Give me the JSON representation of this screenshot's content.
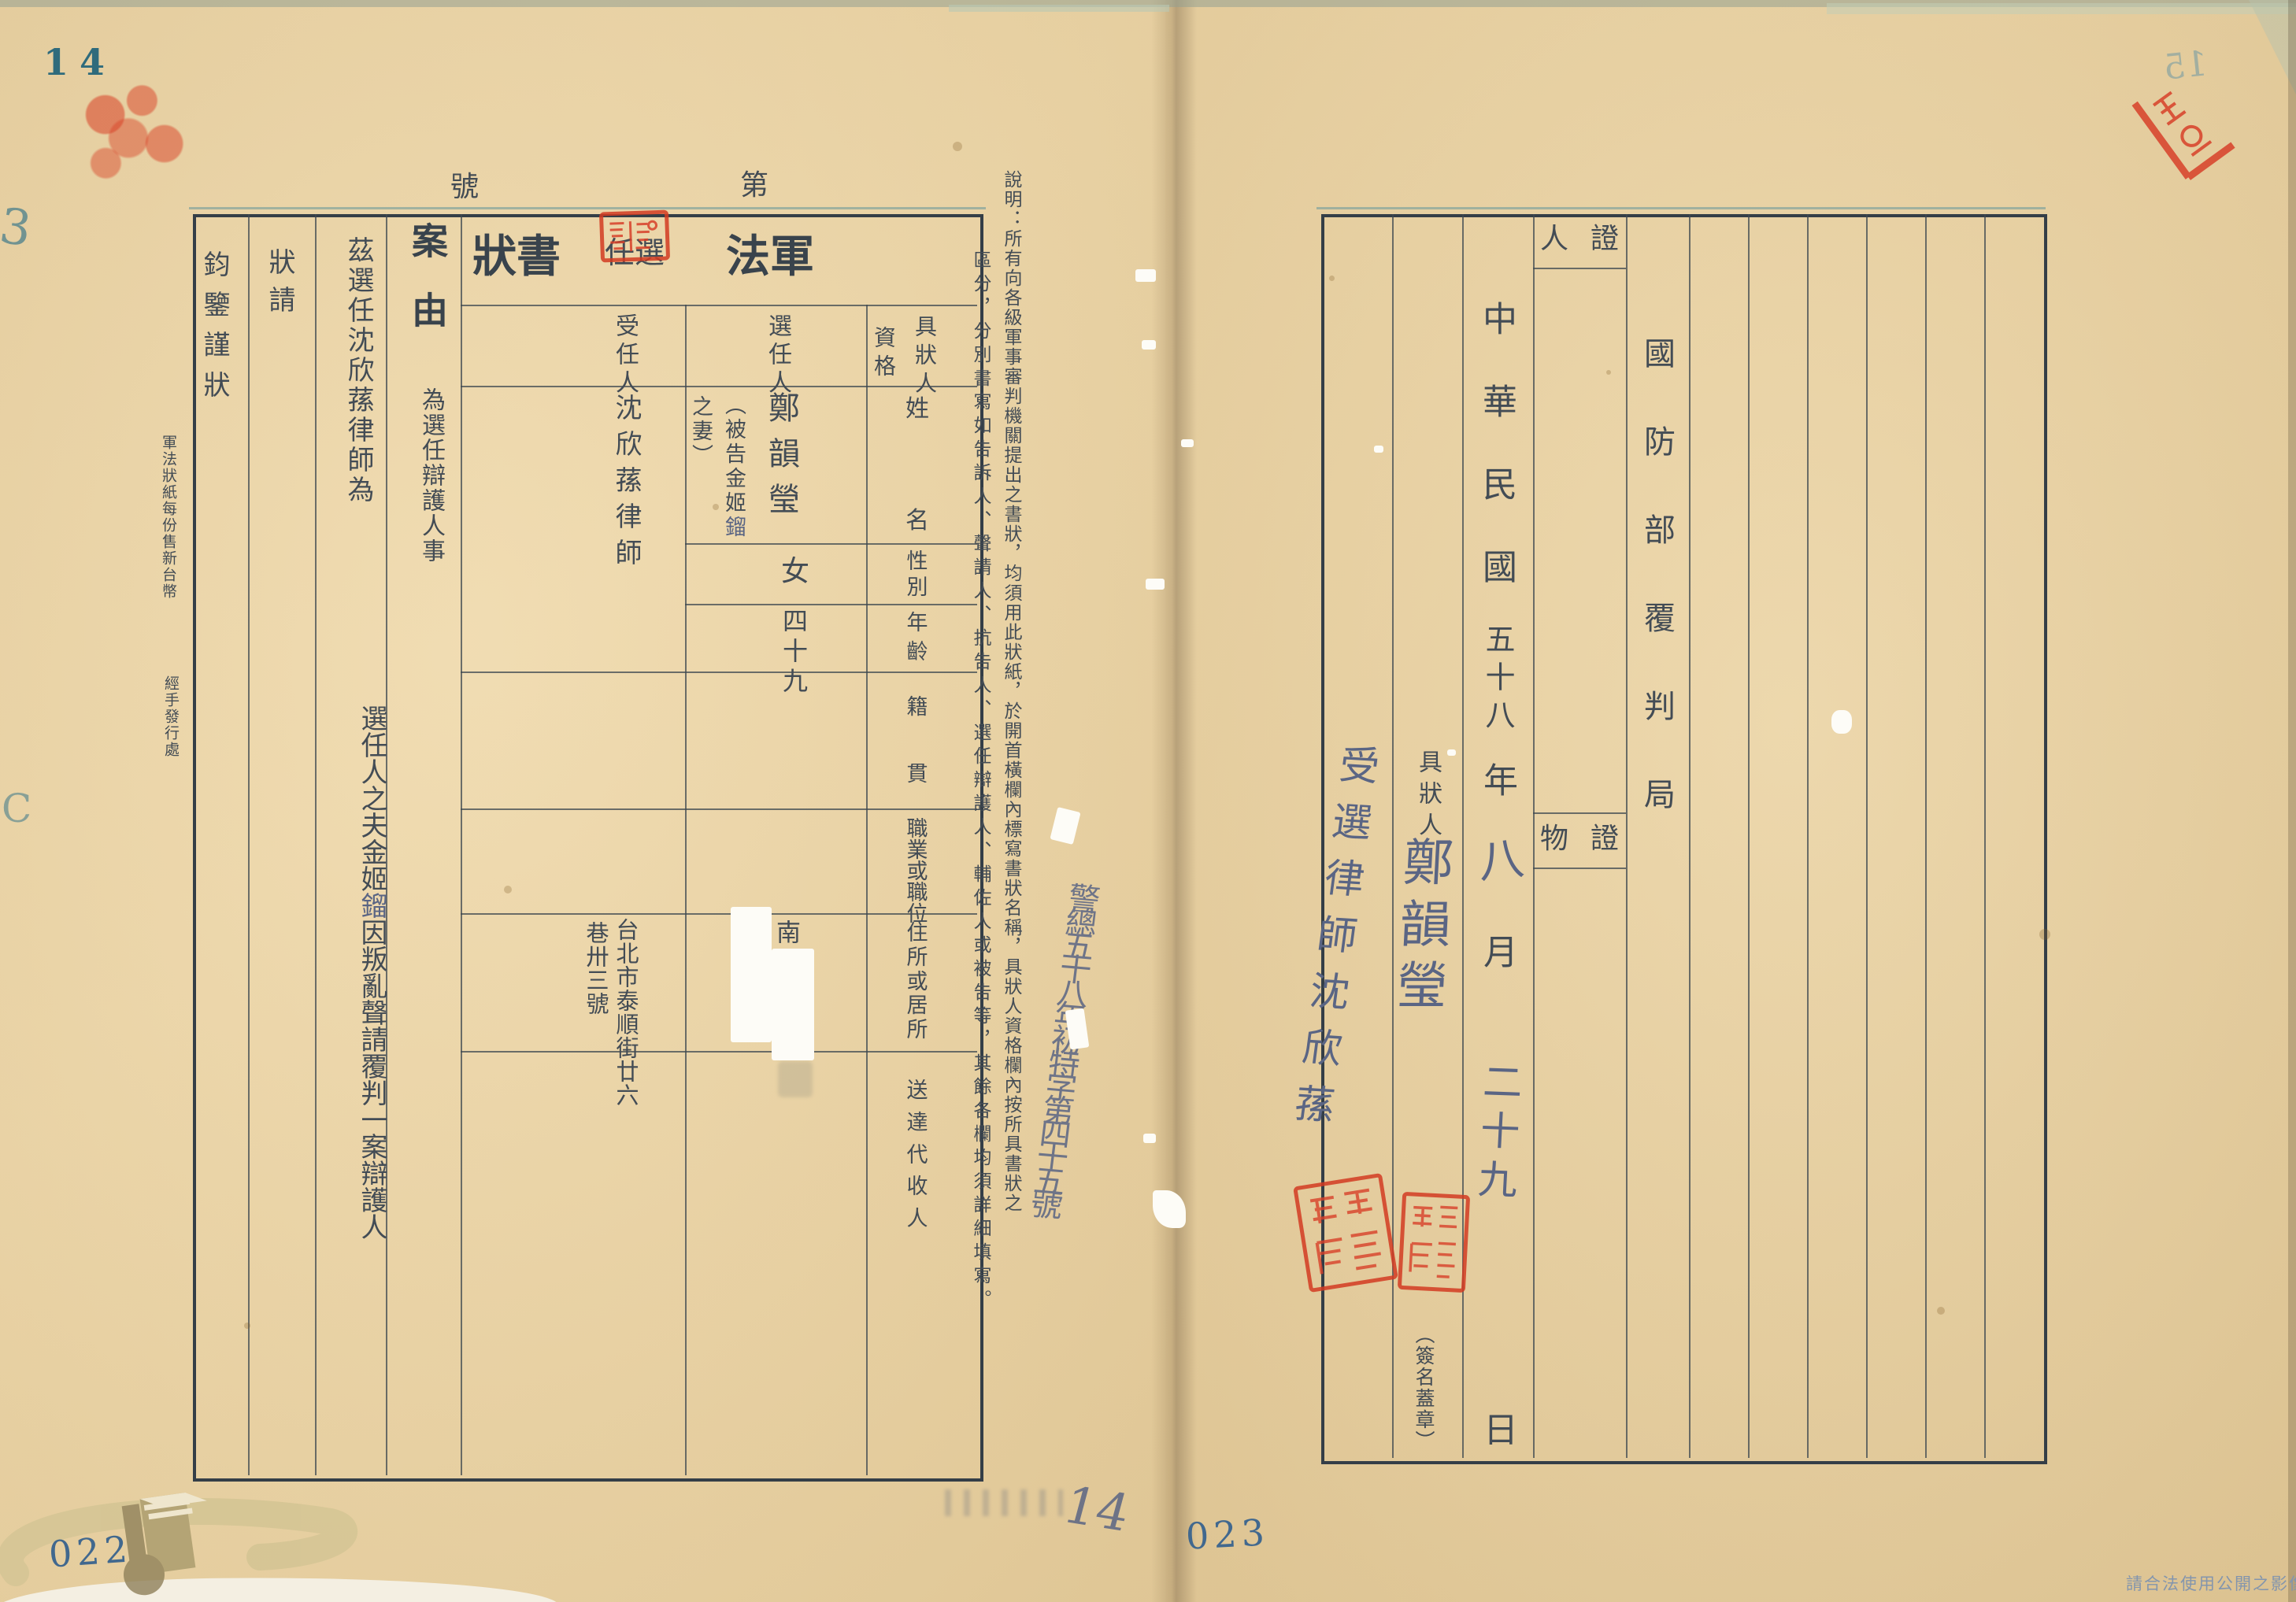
{
  "colors": {
    "seal_red": "#cf3a23",
    "printed_ink": "#434c55",
    "handwriting_ink": "#5a6584",
    "stamp_teal": "#2f6b7c",
    "number_blue": "#41688e"
  },
  "marks": {
    "page_number_left": "14",
    "page_number_right_ghost": "15",
    "edge_mark_top": "3",
    "edge_mark_mid": "C",
    "bottom_left_number": "022",
    "bottom_center_number": "023",
    "bottom_pencil_number": "14",
    "footer_notice": "請合法使用公開之影像",
    "fold_annotation": "警總五十八年初特字第四十五號"
  },
  "left_page": {
    "serial": {
      "prefix": "第",
      "suffix": "號"
    },
    "title": {
      "main_right": "軍法",
      "small": "選任",
      "main_left": "書狀"
    },
    "table": {
      "applicant_header_line1": "具狀人",
      "applicant_header_line2": "資格",
      "selector_header": "選任人",
      "appointee_header": "受任人",
      "row_labels": [
        "姓名",
        "性別",
        "年齡",
        "籍貫",
        "職業或職位",
        "住所或居所",
        "送達代收人"
      ],
      "selector": {
        "name": "鄭韻瑩",
        "name_note_line1": "（被告金姬",
        "name_note_hand": "鎦",
        "name_note_line2": "之妻）",
        "sex": "女",
        "age": "四十九",
        "residence": "南投"
      },
      "appointee": {
        "name": "沈欣蓀律師",
        "residence_line1": "台北市泰順街廿六",
        "residence_line2": "巷卅三號"
      }
    },
    "cause_label": "案由",
    "cause_value": "為選任辯護人事",
    "body_seg1": "茲選任沈欣蓀律師為",
    "body_seg2_before": "選任人之夫金姬",
    "body_seg2_hand": "鎦",
    "body_seg2_after": "因叛亂聲請覆判一案辯護人",
    "petition": "狀請",
    "closing": "鈞鑒謹狀",
    "margin_price": "軍法狀紙每份售新台幣",
    "margin_issuer": "經手發行處",
    "note_col1": "說明：所有向各級軍事審判機關提出之書狀，均須用此狀紙，於開首橫欄內標寫書狀名稱，具狀人資格欄內按所具書狀之",
    "note_col2": "區分，分別書寫如告訴人、聲請人、抗告人、選任辯護人、輔佐人或被告等，其餘各欄均須詳細填寫。"
  },
  "right_page": {
    "agency": "國防部覆判局",
    "witness_header": "證人",
    "evidence_header": "證物",
    "date": {
      "era": "中華民國",
      "year": "五十八",
      "year_unit": "年",
      "month_hand": "八",
      "month_unit": "月",
      "day_hand": "二十九",
      "day_unit": "日"
    },
    "signer": {
      "label": "具狀人",
      "name_hand": "鄭韻瑩",
      "lawyer_hand": "受選律師沈欣蓀",
      "sign_note": "（簽名蓋章）"
    }
  }
}
